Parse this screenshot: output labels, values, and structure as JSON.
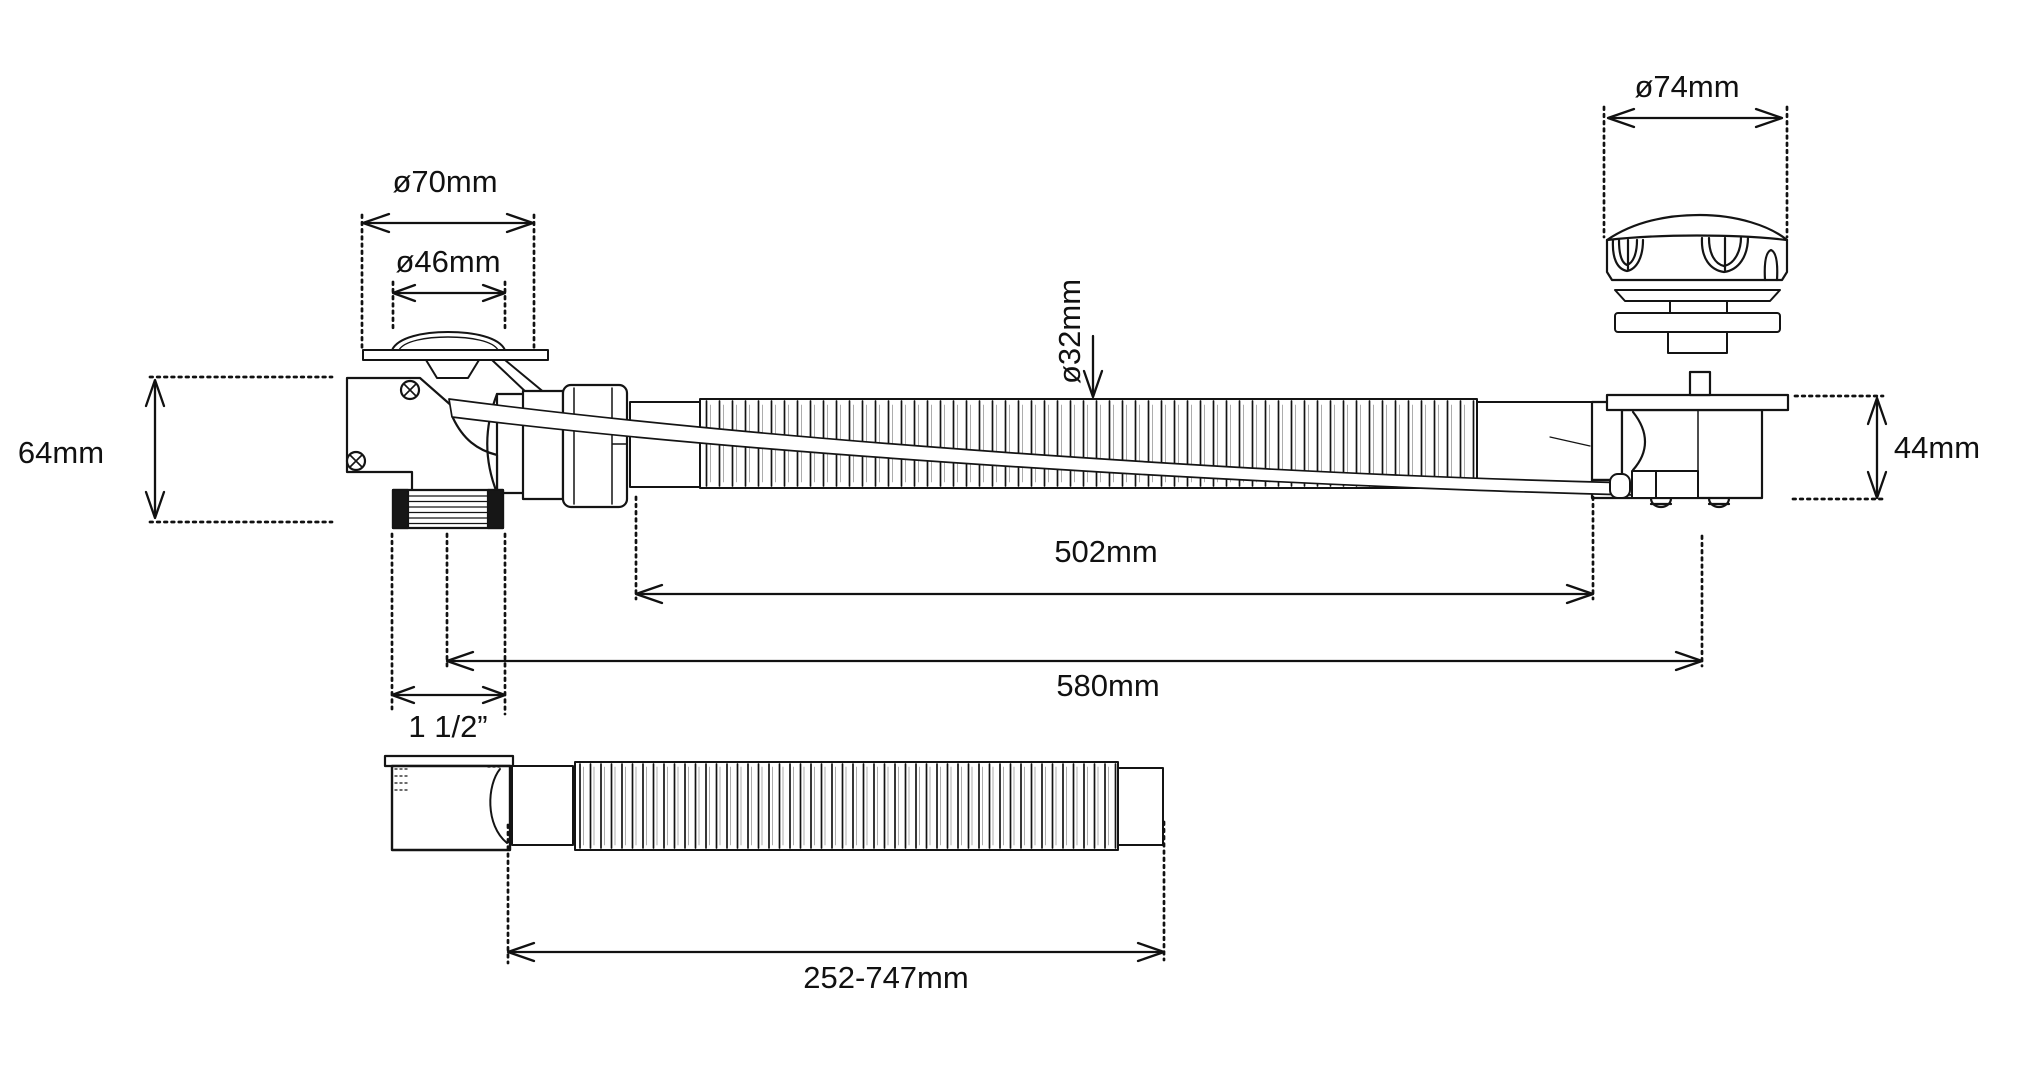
{
  "drawing": {
    "type": "technical-line-drawing",
    "subject": "bath-waste-and-overflow-kit",
    "background_color": "#ffffff",
    "ink_color": "#141414",
    "dimensions": {
      "flange_diameter": "ø70mm",
      "plug_diameter": "ø46mm",
      "cap_diameter": "ø74mm",
      "hose_diameter": "ø32mm",
      "waste_body_height": "64mm",
      "overflow_body_height": "44mm",
      "hose_length": "502mm",
      "overall_length": "580mm",
      "thread_size": "1 1/2”",
      "outlet_hose_length": "252-747mm"
    }
  }
}
